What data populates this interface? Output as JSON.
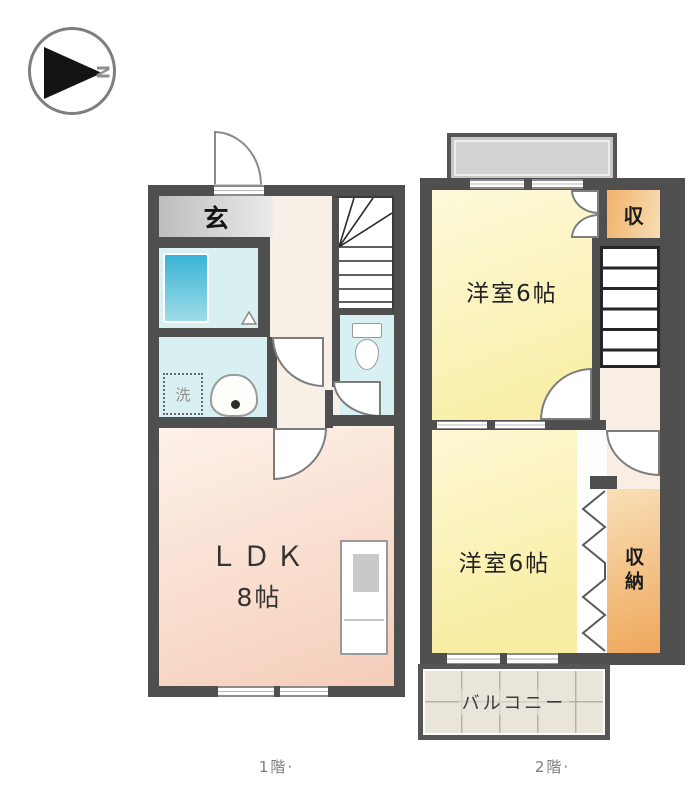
{
  "compass": {
    "letter": "N"
  },
  "colors": {
    "wall": "#4f4f4f",
    "wet_room_cyan": "#d8f0f2",
    "bathtub_blue": "#39b4d4",
    "ldk_pink": "#f8d8c7",
    "bedroom_yellow": "#f9efaa",
    "storage_orange": "#efa75a",
    "entrance_gray": "#c6c6c6",
    "balcony_tile": "#e9e5db",
    "hallway_cream": "#f8efe6"
  },
  "floor1": {
    "caption": "1階·",
    "entrance_label": "玄",
    "laundry_label": "洗",
    "ldk_line1": "ＬＤＫ",
    "ldk_line2": "8帖"
  },
  "floor2": {
    "caption": "2階·",
    "bedroom_top_label": "洋室6帖",
    "bedroom_bottom_label": "洋室6帖",
    "closet_label": "収",
    "storage_label": "収納",
    "balcony_label": "バルコニー"
  }
}
